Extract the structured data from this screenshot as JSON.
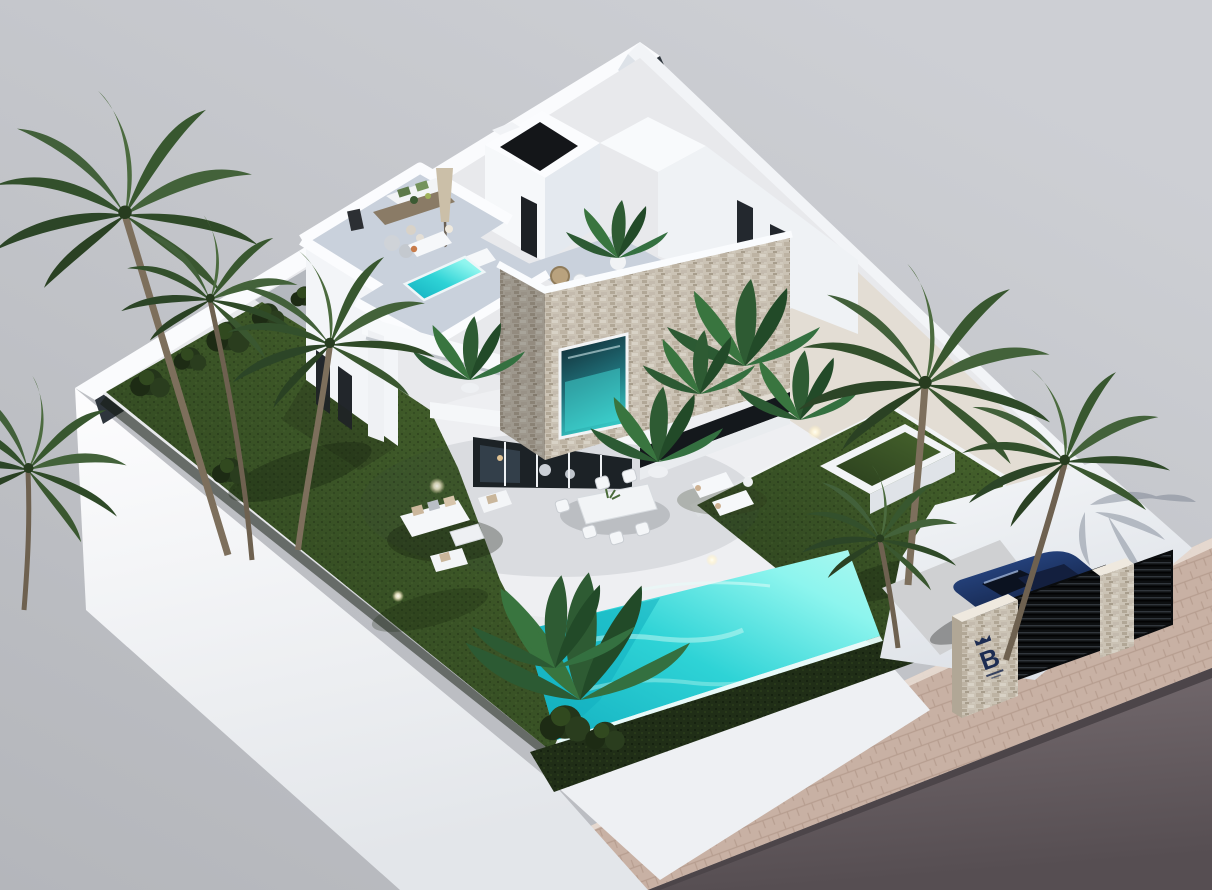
{
  "scene": {
    "description": "Aerial isometric 3D architectural visualization of a modern two-storey white villa on a walled corner plot with garden, turquoise infinity pool, roof terraces, carport with car, and street at the lower right",
    "view": "aerial three-quarter",
    "lighting": "bright daylight"
  },
  "branding": {
    "gate_pillar_logo": "B"
  },
  "inventory": {
    "palm_trees": 7,
    "roof_terraces": 3,
    "swimming_pools": 2,
    "sun_loungers_roof": 2,
    "sun_loungers_ground": 2,
    "outdoor_dining_chairs": 6,
    "lounge_sofa_sets": 1,
    "cars": 1,
    "gate_pillars": 2,
    "garden_uplights": 8
  },
  "colors": {
    "backdrop": "#c6c8cc",
    "backdrop_dark": "#b6b8bd",
    "wall_white": "#f7f8fa",
    "wall_shade": "#e2e6ec",
    "inner_shadow": "#2e353c",
    "patio": "#e8e9ec",
    "terrace_deck": "#c9d1dc",
    "lawn_lit": "#47642d",
    "lawn_dark": "#2a3f1d",
    "hedge": "#202e17",
    "pool_bright": "#8df5ee",
    "pool_mid": "#2ed3d6",
    "pool_deep": "#12aebf",
    "stone_beige": "#cbc3b5",
    "glass": "#1c2226",
    "window_teal": "#35c4c2",
    "trunk_brown": "#7d6f5c",
    "palm_green": "#3e5c34",
    "car_blue": "#2c4f93",
    "car_dark": "#101c3a",
    "gate_dark": "#0d0f11",
    "driveway": "#cfd0d2",
    "sidewalk": "#c8b1a4",
    "sidewalk_line": "#b3988a",
    "road": "#6e6468",
    "logo_navy": "#1d2d52",
    "uplight_glow": "#fff6d9",
    "parasol_beige": "#cbbfa8",
    "rattan_tan": "#b9a27e",
    "table_wood": "#8a7b66"
  }
}
